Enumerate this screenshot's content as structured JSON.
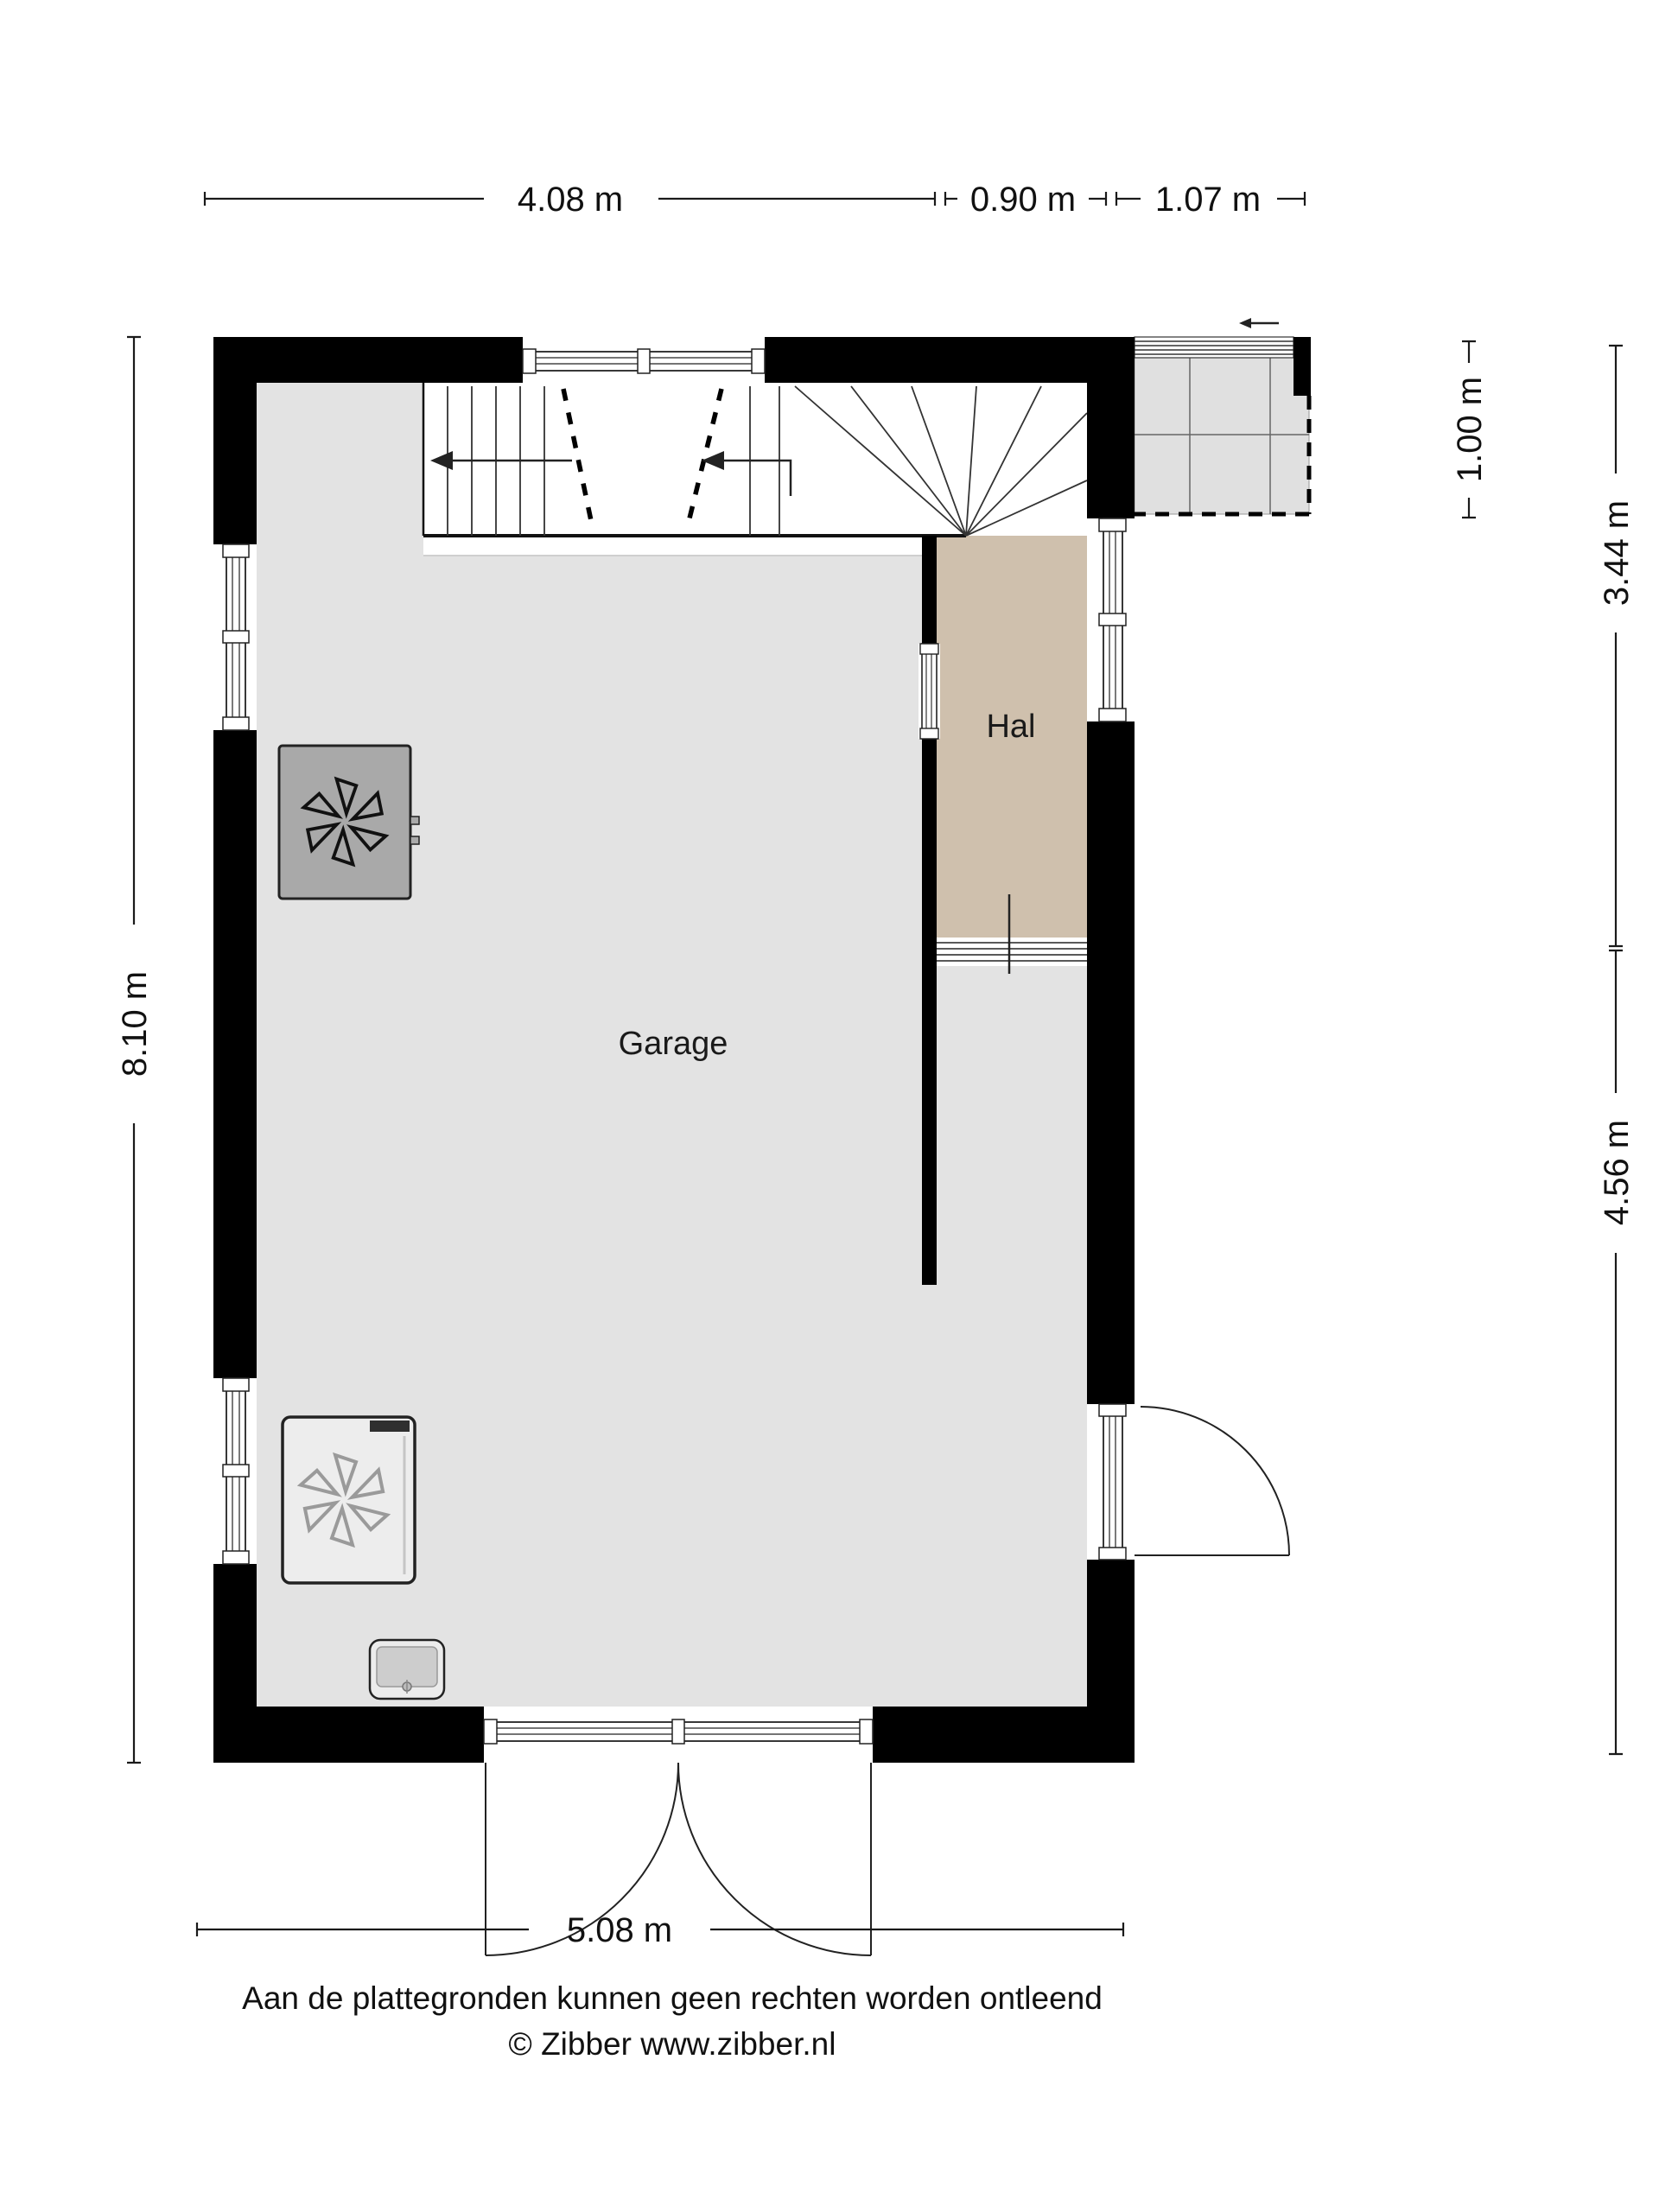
{
  "plan": {
    "title": "floor-plan",
    "rooms": {
      "garage": "Garage",
      "hal": "Hal"
    },
    "dims": {
      "top_main": "4.08 m",
      "top_mid": "0.90 m",
      "top_right": "1.07 m",
      "left": "8.10 m",
      "right_top": "1.00 m",
      "right_mid": "3.44 m",
      "right_bottom": "4.56 m",
      "bottom": "5.08 m"
    },
    "footer": {
      "line1": "Aan de plattegronden kunnen geen rechten worden ontleend",
      "line2": "© Zibber www.zibber.nl"
    },
    "colors": {
      "wall": "#000000",
      "garage_floor": "#e3e3e3",
      "hal_floor": "#cfc0ad",
      "porch_tile": "#e0e0e0",
      "stair": "#ffffff",
      "unit_gray": "#a9a9a9",
      "unit_light": "#ededed"
    },
    "icons": {
      "fan_top": "fan-icon",
      "fan_bottom": "fan-icon",
      "sink": "sink-icon",
      "entry_arrow": "arrow-left-icon",
      "stair_arrow_left": "arrow-left-icon",
      "stair_arrow_right": "arrow-left-icon"
    }
  }
}
